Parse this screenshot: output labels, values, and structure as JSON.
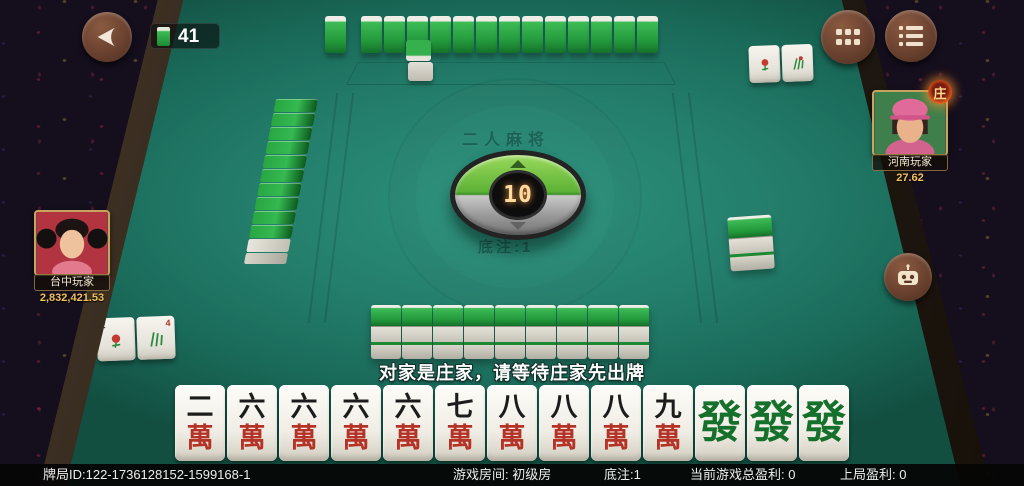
{
  "hud": {
    "tiles_remaining": "41"
  },
  "players": {
    "left": {
      "name": "台中玩家",
      "balance": "2,832,421.53"
    },
    "right": {
      "name": "河南玩家",
      "balance": "27.62",
      "dealer_badge": "庄"
    }
  },
  "table": {
    "watermark_title": "二人麻将",
    "base_bet_watermark": "底注:1",
    "dice_counter": "10",
    "walls": {
      "top_row": 13,
      "top_single": 1,
      "left_column": 10,
      "bottom_columns": 9,
      "right_columns": 1
    }
  },
  "melds": {
    "bottom_left_tiles": [
      {
        "kind": "flower",
        "corner": "2"
      },
      {
        "kind": "flower",
        "corner": "4"
      }
    ],
    "top_right_tiles": [
      {
        "kind": "flower"
      },
      {
        "kind": "flower"
      }
    ]
  },
  "message": "对家是庄家，请等待庄家先出牌",
  "hand": [
    {
      "top": "二",
      "bottom": "萬"
    },
    {
      "top": "六",
      "bottom": "萬"
    },
    {
      "top": "六",
      "bottom": "萬"
    },
    {
      "top": "六",
      "bottom": "萬"
    },
    {
      "top": "六",
      "bottom": "萬"
    },
    {
      "top": "七",
      "bottom": "萬"
    },
    {
      "top": "八",
      "bottom": "萬"
    },
    {
      "top": "八",
      "bottom": "萬"
    },
    {
      "top": "八",
      "bottom": "萬"
    },
    {
      "top": "九",
      "bottom": "萬"
    },
    {
      "top": "發",
      "bottom": ""
    },
    {
      "top": "發",
      "bottom": ""
    },
    {
      "top": "發",
      "bottom": ""
    }
  ],
  "status_bar": {
    "items": [
      "牌局ID:122-1736128152-1599168-1",
      "游戏房间: 初级房",
      "底注:1",
      "当前游戏总盈利: 0",
      "上局盈利: 0"
    ]
  },
  "colors": {
    "felt": "#247f6c",
    "tile_back_green": "#23993c",
    "gold_text": "#f0c05a",
    "red_char": "#b43226",
    "green_char": "#15702c",
    "dial_digit": "#ffd9a0"
  }
}
